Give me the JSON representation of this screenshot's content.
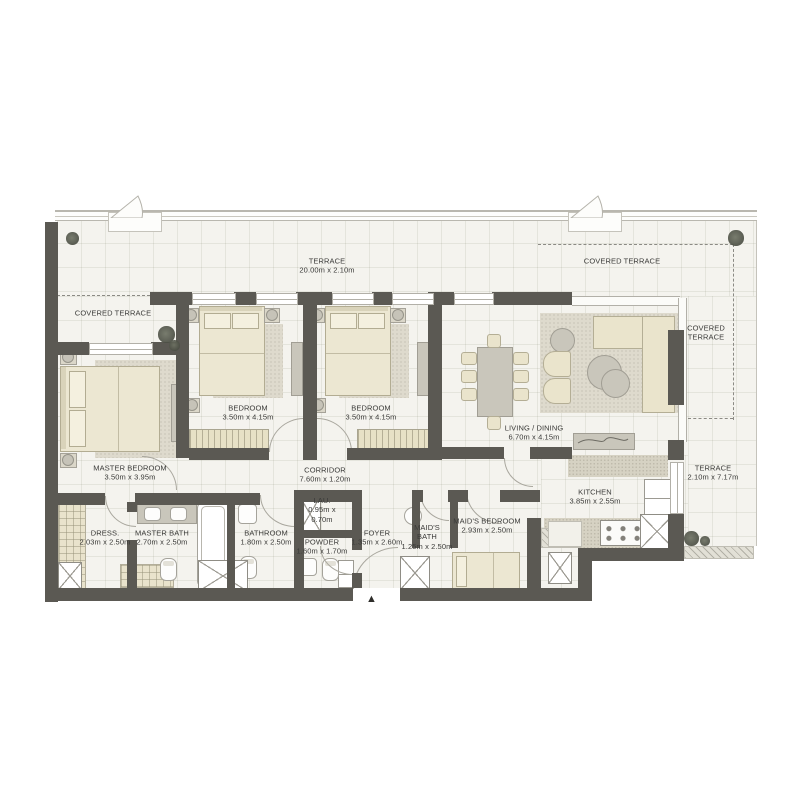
{
  "plan": {
    "entrance_arrow": "▲",
    "colors": {
      "wall": "#5b5953",
      "floor": "#f4f3ee",
      "furniture_beige": "#eae4cc",
      "furniture_gray": "#c9c6bb",
      "dashed_line": "#8b8a84",
      "label_text": "#3a3a38"
    },
    "rooms": [
      {
        "id": "terrace-top",
        "name": "TERRACE",
        "dims": "20.00m x 2.10m"
      },
      {
        "id": "covered-terrace-left",
        "name": "COVERED TERRACE"
      },
      {
        "id": "covered-terrace-top-right",
        "name": "COVERED TERRACE"
      },
      {
        "id": "covered-terrace-right",
        "name": "COVERED TERRACE"
      },
      {
        "id": "master-bedroom",
        "name": "MASTER BEDROOM",
        "dims": "3.50m x 3.95m"
      },
      {
        "id": "bedroom-1",
        "name": "BEDROOM",
        "dims": "3.50m x 4.15m"
      },
      {
        "id": "bedroom-2",
        "name": "BEDROOM",
        "dims": "3.50m x 4.15m"
      },
      {
        "id": "living-dining",
        "name": "LIVING / DINING",
        "dims": "6.70m x 4.15m"
      },
      {
        "id": "corridor",
        "name": "CORRIDOR",
        "dims": "7.60m x 1.20m"
      },
      {
        "id": "laundry",
        "name": "LAU.",
        "dims": "0.95m x 0.70m"
      },
      {
        "id": "dress",
        "name": "DRESS.",
        "dims": "2.03m x 2.50m"
      },
      {
        "id": "master-bath",
        "name": "MASTER BATH",
        "dims": "2.70m x 2.50m"
      },
      {
        "id": "bathroom",
        "name": "BATHROOM",
        "dims": "1.80m x 2.50m"
      },
      {
        "id": "powder",
        "name": "POWDER",
        "dims": "1.60m x 1.70m"
      },
      {
        "id": "foyer",
        "name": "FOYER",
        "dims": "1.35m x 2.60m"
      },
      {
        "id": "maids-bath",
        "name": "MAID'S BATH",
        "dims": "1.25m x 2.50m"
      },
      {
        "id": "maids-bedroom",
        "name": "MAID'S BEDROOM",
        "dims": "2.93m x 2.50m"
      },
      {
        "id": "kitchen",
        "name": "KITCHEN",
        "dims": "3.85m x 2.55m"
      },
      {
        "id": "terrace-right",
        "name": "TERRACE",
        "dims": "2.10m x 7.17m"
      }
    ]
  }
}
